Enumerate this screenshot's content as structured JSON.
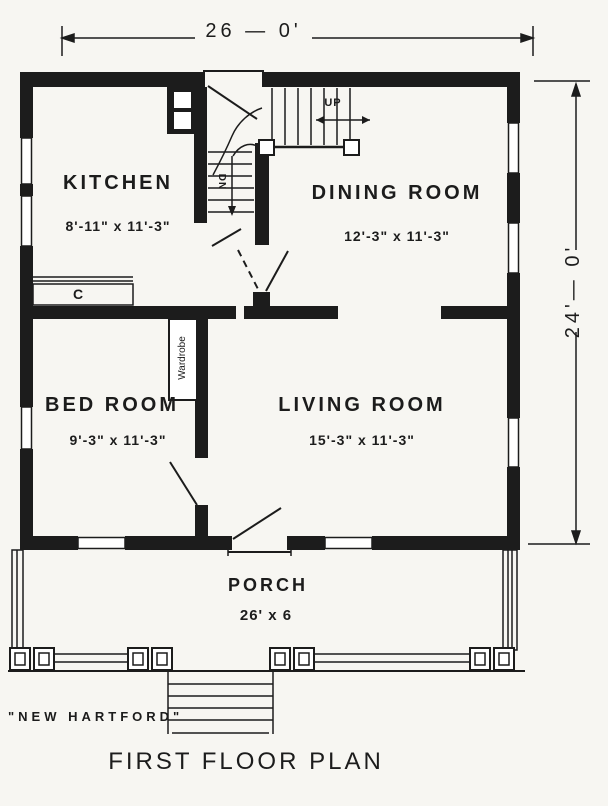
{
  "page": {
    "paper_color": "#f7f6f2",
    "ink_color": "#1c1c1c",
    "plan_name": "\"NEW HARTFORD\"",
    "title": "FIRST FLOOR PLAN"
  },
  "dimensions": {
    "overall_width": "26 — 0'",
    "overall_depth": "24'— 0'"
  },
  "rooms": {
    "kitchen": {
      "name": "KITCHEN",
      "size": "8'-11\" x 11'-3\""
    },
    "dining": {
      "name": "DINING ROOM",
      "size": "12'-3\" x 11'-3\""
    },
    "bed": {
      "name": "BED ROOM",
      "size": "9'-3\" x 11'-3\""
    },
    "living": {
      "name": "LIVING ROOM",
      "size": "15'-3\" x 11'-3\""
    },
    "porch": {
      "name": "PORCH",
      "size": "26' x 6"
    }
  },
  "stairs": {
    "up_label": "UP",
    "down_label": "DN"
  },
  "fixtures": {
    "wardrobe_label": "Wardrobe",
    "counter_label": "C"
  }
}
